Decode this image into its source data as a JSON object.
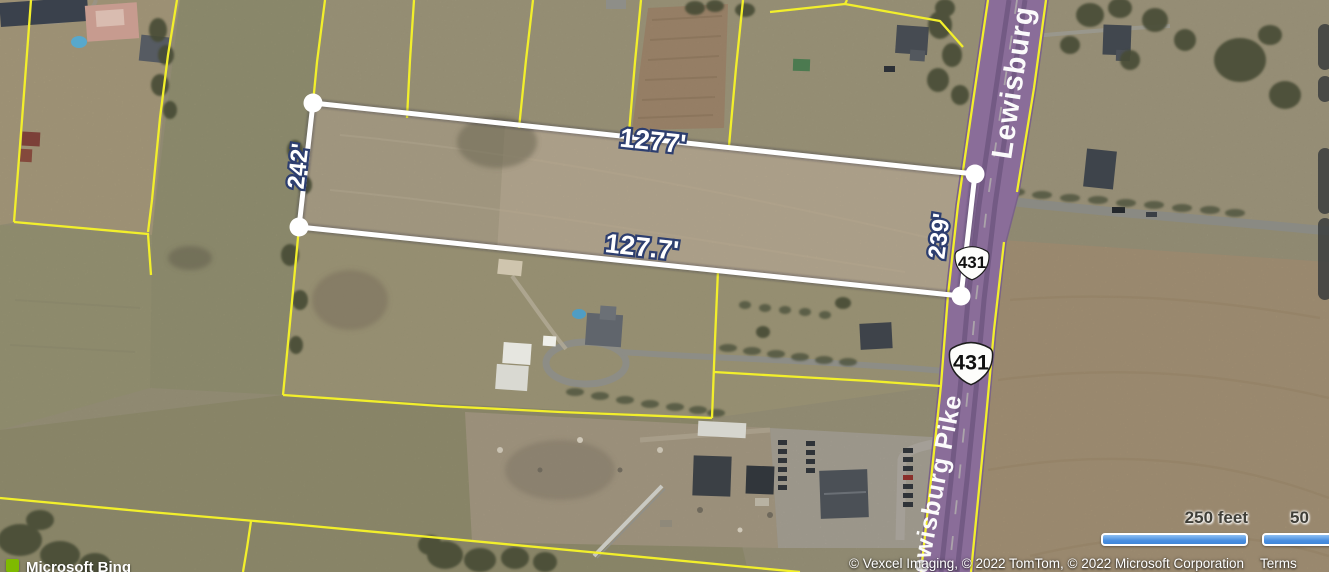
{
  "map_overlay": {
    "measurements": {
      "top": "1277'",
      "bottom": "127.7'",
      "left": "242'",
      "right": "239'"
    },
    "roads": {
      "label_top": "Lewisburg P",
      "label_bottom": "Lewisburg Pike",
      "route_shield_upper": "431",
      "route_shield_lower": "431"
    },
    "scale_bar": {
      "imperial_label": "250 feet",
      "metric_label": "50"
    },
    "attribution": {
      "providers": "© Vexcel Imaging, © 2022 TomTom, © 2022 Microsoft Corporation",
      "terms": "Terms"
    },
    "branding": {
      "logo_text": "Microsoft Bing"
    },
    "colors": {
      "parcel_boundary": "#f2ef2b",
      "measure_line": "#ffffff",
      "measure_label_outline": "#2d3e6f",
      "road_overlay": "#8a6d99",
      "scale_bar_fill": "#4a8fe0",
      "bing_green": "#7fba00"
    }
  }
}
